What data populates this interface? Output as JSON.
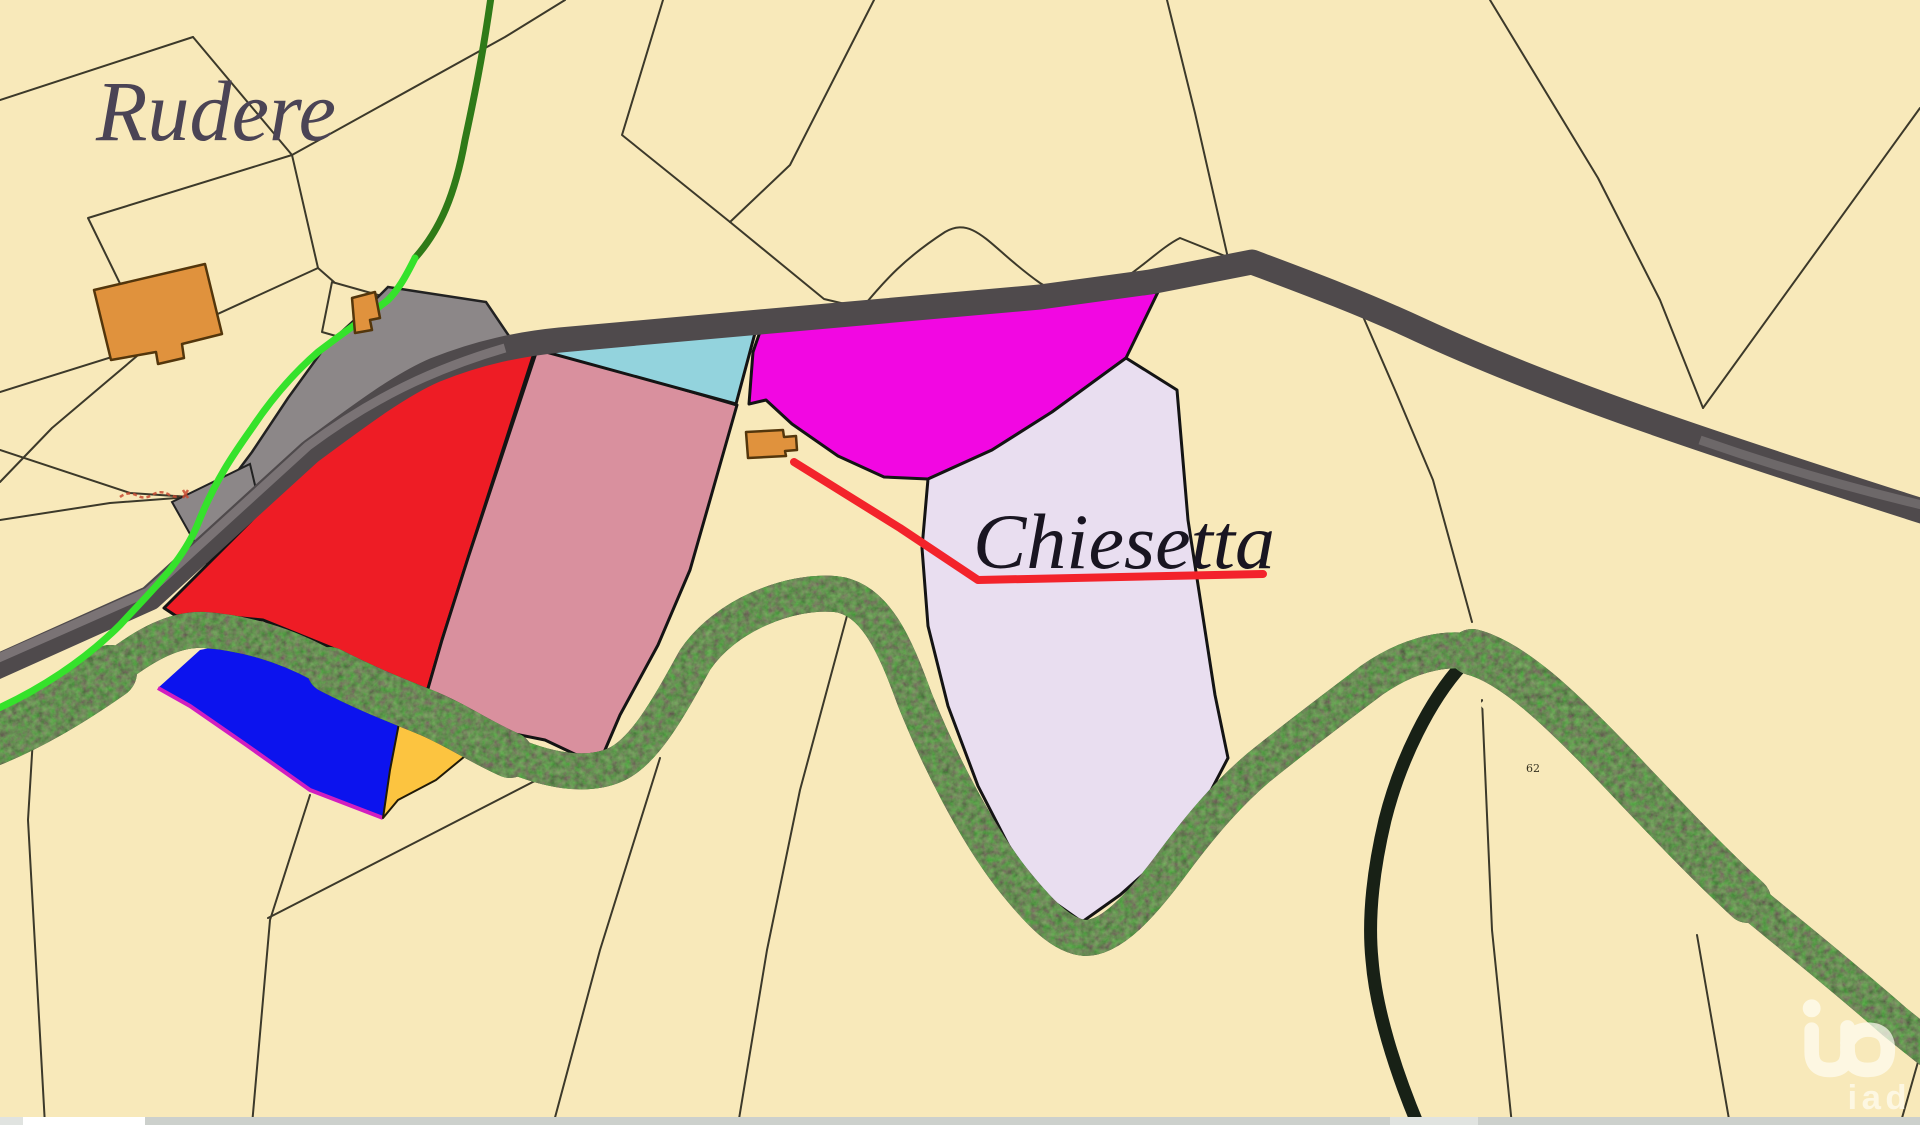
{
  "map": {
    "labels": {
      "rudere": "Rudere",
      "chiesetta": "Chiesetta",
      "parcel_number": "62"
    },
    "watermark": {
      "brand": "iad"
    }
  },
  "colors": {
    "background": "#f8e9ba",
    "boundary_line": "#3c392a",
    "road": "#4f4a4c",
    "road_light": "#7e787a",
    "river": "#182116",
    "river_speckle": "#2c3f24",
    "path_green_bright": "#35e22b",
    "path_green_dark": "#2f7a18",
    "parcel_gray": "#8c8788",
    "parcel_red": "#ee1c25",
    "parcel_pink": "#d9909e",
    "parcel_cyan": "#93d3dd",
    "parcel_magenta": "#f207e2",
    "parcel_lavender": "#e9def0",
    "parcel_blue": "#0c13ee",
    "parcel_blue_edge": "#d21ec0",
    "parcel_gold": "#fcc440",
    "building_fill": "#e0923d",
    "building_outline": "#53360c",
    "red_line": "#f3232b",
    "red_note": "#c84b32",
    "text_rudere": "#4b4455",
    "text_chiesetta": "#191521",
    "text_parcel_number": "#35311f",
    "scrollbar_track": "#ccd0cc",
    "scrollbar_thumb": "#ffffff",
    "scrollbar_light": "#e0e3e0",
    "watermark_color": "#fffdf2"
  }
}
